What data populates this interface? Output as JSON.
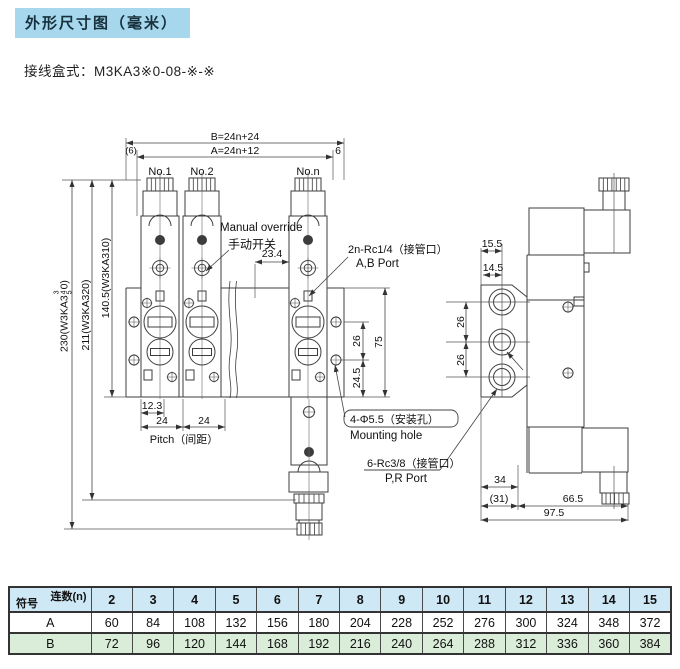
{
  "title": "外形尺寸图（毫米）",
  "subtitle": "接线盒式：M3KA3※0-08-※-※",
  "front_view": {
    "station_labels": [
      "No.1",
      "No.2",
      "No.n"
    ],
    "dims": {
      "overall_b": "B=24n+24",
      "overall_a": "A=24n+12",
      "end_left": "(6)",
      "end_right": "6",
      "valve_gap": "23.4",
      "height_total_prefix": "230(W3KA3",
      "height_total_variants": [
        "3",
        "4",
        "5"
      ],
      "height_total_suffix": "0)",
      "height_mid": "211(W3KA320)",
      "height_upper": "140.5(W3KA310)",
      "port_offset": "12.3",
      "pitch_1": "24",
      "pitch_2": "24",
      "pitch_label": "Pitch（间距）",
      "port_row_spacing": "26",
      "hole_to_bottom": "24.5",
      "base_height": "75"
    },
    "callouts": {
      "manual_override_en": "Manual override",
      "manual_override_zh": "手动开关",
      "ab_port_zh": "2n-Rc1/4（接管口）",
      "ab_port_en": "A,B Port",
      "mounting_zh": "4-Φ5.5（安装孔）",
      "mounting_en": "Mounting hole",
      "pr_port_zh": "6-Rc3/8（接管口）",
      "pr_port_en": "P,R Port"
    }
  },
  "side_view": {
    "dims": {
      "top_width_1": "15.5",
      "top_width_2": "14.5",
      "port_spacing_1": "26",
      "port_spacing_2": "26",
      "bottom_width_1": "34",
      "bottom_width_2": "(31)",
      "bottom_width_3": "66.5",
      "bottom_total": "97.5"
    }
  },
  "table": {
    "corner_top": "连数(n)",
    "corner_bottom": "符号",
    "columns": [
      "2",
      "3",
      "4",
      "5",
      "6",
      "7",
      "8",
      "9",
      "10",
      "11",
      "12",
      "13",
      "14",
      "15"
    ],
    "rows": [
      {
        "label": "A",
        "values": [
          "60",
          "84",
          "108",
          "132",
          "156",
          "180",
          "204",
          "228",
          "252",
          "276",
          "300",
          "324",
          "348",
          "372"
        ]
      },
      {
        "label": "B",
        "values": [
          "72",
          "96",
          "120",
          "144",
          "168",
          "192",
          "216",
          "240",
          "264",
          "288",
          "312",
          "336",
          "360",
          "384"
        ]
      }
    ]
  },
  "colors": {
    "title_bg": "#a6d7ec",
    "table_header_bg": "#cfe8f6",
    "table_row_b_bg": "#d9edd8",
    "line": "#3d3d3d"
  }
}
